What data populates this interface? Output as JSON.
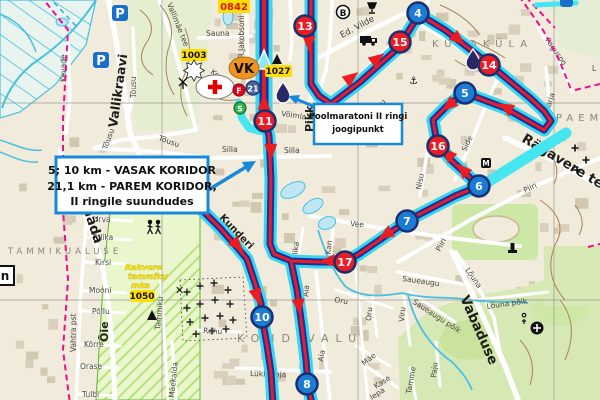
{
  "callouts": {
    "corridor": {
      "line1": "5; 10 km - VASAK KORIDOR",
      "line2": "21,1 km - PAREM KORIDOR,",
      "line3": "II ringile suundudes"
    },
    "waterpoint": {
      "line1": "Poolmaratoni II ringi",
      "line2": "joogipunkt"
    }
  },
  "markers": {
    "km4": "4",
    "km5": "5",
    "km6": "6",
    "km7": "7",
    "km8": "8",
    "km10": "10",
    "km11": "11",
    "km13": "13",
    "km14": "14",
    "km15": "15",
    "km16": "16",
    "km17": "17"
  },
  "badges": {
    "vk": "VK",
    "finish": "F",
    "start": "S",
    "km21": "21",
    "bus": "B",
    "museum": "M",
    "parking": "P",
    "label_n": "n"
  },
  "codes": {
    "c0842": "0842",
    "c1003": "1003",
    "c1027": "1027",
    "c1050": "1050"
  },
  "areas": {
    "kukakula": "KUKAKÜLA",
    "kondivalu": "KONDIVALU",
    "tammikualuse": "TAMMIKUALUSE",
    "paemurru": "PAEMU",
    "park1": "Rakvere",
    "park2": "tammiku",
    "park3": "mka"
  },
  "icons": {
    "quarry": "✕",
    "windmill": "✕",
    "anchor": "⚓"
  },
  "streets": {
    "vallikraavi": "Vallikraavi",
    "kevade": "Kevade",
    "vallimae": "Vallimäe tee",
    "tousu1": "Tõusu",
    "tousu2": "Tõusu",
    "tousu3": "Tõusu",
    "sauna": "Sauna",
    "jakobsoni": "C.R.Jakobsoni",
    "edvilde": "Ed. Vilde",
    "voimla": "Võimla",
    "pikk": "Pikk",
    "silla1": "Silla",
    "silla2": "Silla",
    "vee": "Vee",
    "allika": "Allika",
    "kan": "A.Kan",
    "nisu": "Nisu",
    "side": "Side",
    "piiri1": "Piiri",
    "piiri2": "Piiri",
    "ragavere": "Rägavere tee",
    "pagusoo": "Pagusoo",
    "karja": "Karja",
    "kunderi": "Kunderi",
    "rahu": "Rahu",
    "urva": "Urva",
    "tulika": "Tulika",
    "kirsi": "Kirsi",
    "mooni": "Mooni",
    "pollu": "Põllu",
    "korre": "Kõrre",
    "orase": "Orase",
    "tulbi": "Tulbi",
    "vahtra": "Vahtra pst",
    "oie": "Õie",
    "tammiku": "Tammiku",
    "maekalda": "Mäekalda",
    "aia1": "Aia",
    "aia2": "Aia",
    "oru1": "Oru",
    "oru2": "Oru",
    "mae": "Mäe",
    "kase": "Kase",
    "lepa": "lepa",
    "lukkeraja": "Lükkeraja",
    "saueaugu1": "Saueaugu",
    "saueaugu2": "Saueaugu põik",
    "louna": "Lõuna",
    "lounapoik": "Lõuna põik",
    "vabaduse": "Vabaduse",
    "viru": "Viru",
    "paju": "Paju",
    "tamme": "Tamme",
    "ko": "Ko",
    "hitu": "hitu",
    "mada": "Mäda",
    "el": "L"
  }
}
